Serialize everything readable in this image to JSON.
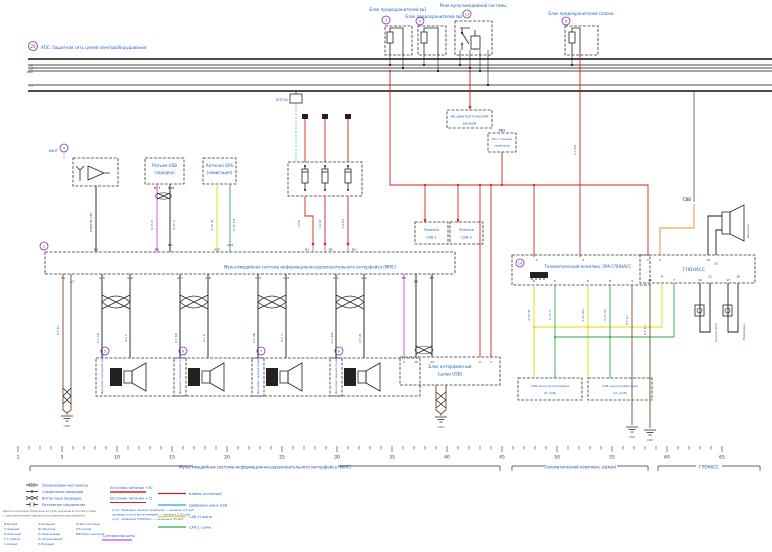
{
  "diagram": {
    "note": {
      "marker": "29",
      "text": "АПС: Защитная сеть цепей электрооборудования"
    },
    "bus": {
      "labels": [
        "30",
        "15",
        "ACC",
        "31"
      ]
    },
    "top": {
      "fuse1": {
        "marker": "3",
        "label": "Блок предохранителей №1"
      },
      "fuse2": {
        "marker": "4",
        "label": "Блок предохранителей №2"
      },
      "relay": {
        "marker": "13",
        "label": "Реле мультимедийной системы"
      },
      "fuse3": {
        "marker": "6",
        "label": "Блок предохранителей салона"
      },
      "svv": "СВВ"
    },
    "left": {
      "ant": {
        "marker": "9",
        "label": "ХАНТ",
        "box": "Усилитель антенны",
        "wire": "КАБЕЛЬ АНТ"
      },
      "usb": {
        "line1": "Разъем USB",
        "line2": "(зарядка)",
        "pin1": "М17",
        "pin2": "М18",
        "wire1": "0,35 Р",
        "wire2": "0,35 Ч"
      },
      "gps": {
        "line1": "Антенна GPS",
        "line2": "(навигация)",
        "wire1": "0,35 Ж",
        "wire2": "0,35 ГЛ"
      },
      "gnd": "GND",
      "gnd_wire": "0,5 Кч"
    },
    "fusebox": {
      "label": "АПТОК",
      "w1": "1,0 К",
      "w2": "1,0 КГ",
      "w3": "1,0 КЗ"
    },
    "head": {
      "marker": "1",
      "label": "Мультимедийная система информационно-развлекательного интерфейса (ММС)",
      "top_pins": [
        "М1",
        "М5",
        "М6",
        "А25",
        "А24",
        "В1",
        "В2",
        "В3"
      ],
      "bottom_pins": [
        "А1",
        "А2",
        "А15",
        "А16",
        "А17",
        "А18",
        "А13",
        "А14",
        "А11",
        "А12",
        "В5",
        "В6",
        "В7"
      ]
    },
    "speakers": [
      {
        "marker": "5",
        "name": "Динамик передний левый",
        "w1": "0,5 СБ",
        "w2": "0,5 С"
      },
      {
        "marker": "6",
        "name": "Динамик передний правый",
        "w1": "0,5 КБ",
        "w2": "0,5 К"
      },
      {
        "marker": "7",
        "name": "Динамик задний левый",
        "w1": "0,5 ЗБ",
        "w2": "0,5 З"
      },
      {
        "marker": "8",
        "name": "Динамик задний правый",
        "w1": "0,5 ЖБ",
        "w2": "0,5 Ж"
      }
    ],
    "mid": {
      "diag": {
        "line1": "На диагностический",
        "line2": "разъем"
      },
      "xv2": {
        "tag": "ХВ2",
        "line1": "Жгут панели",
        "line2": "приборов"
      },
      "usb1": {
        "line1": "Розетка",
        "line2": "USB-1"
      },
      "usb2": {
        "line1": "Розетка",
        "line2": "USB-2"
      },
      "iface": {
        "line1": "Блок интерфейсный",
        "line2": "(шлюз USB)",
        "p1": "4",
        "p2": "10",
        "p3": "14",
        "p4": "2",
        "p5": "3",
        "gnd": "GND"
      }
    },
    "tele": {
      "marker": "14",
      "label": "Телематический комплекс ЭРА-ГЛОНАСС",
      "feed": "2,5 КЗ",
      "tp": [
        "1",
        "2"
      ],
      "bp": [
        "6",
        "5",
        "9",
        "8",
        "4"
      ],
      "w": [
        "0,35 Ж",
        "0,35 З",
        "0,35 ЖЧ",
        "0,35 ЗЧ",
        "0,5 Кч"
      ],
      "gnd": "GND"
    },
    "can1": {
      "line1": "CAN шина мультимедиа",
      "line2": "(K_CAN)"
    },
    "can2": {
      "line1": "CAN шина комбинации",
      "line2": "(CL_CAN)"
    },
    "glonass": {
      "label": "ГЛОНАСС",
      "tp": [
        "1",
        "2",
        "14",
        "15"
      ],
      "bp": [
        "20",
        "8",
        "7",
        "16",
        "11",
        "17",
        "18"
      ],
      "speaker": "Динамик",
      "btn": "Кнопка SOS",
      "mic": "Микрофон",
      "gnd": "GND",
      "w": "0,5 Кч"
    },
    "ruler": {
      "numbers": [
        "1",
        "5",
        "10",
        "15",
        "20",
        "25",
        "30",
        "35",
        "40",
        "45",
        "50",
        "55",
        "60",
        "65"
      ],
      "b1": "Мультимедийная система информационно-развлекательного интерфейса (ММС)",
      "b2": "Телематический комплекс (связи)",
      "b3": "ГЛОНАСС"
    },
    "legend": {
      "symbols": [
        "Экранированный провод",
        "Соединение проводов",
        "Витая пара проводов",
        "Разъемное соединение"
      ],
      "pw1": "Источник питания +30",
      "pw2": "Источник питания +15",
      "c1": "Кабель антенный",
      "c2": "Цифровая шина USB",
      "c3": "CAN_H шина",
      "c4": "CAN_L шина",
      "c5": "Сигнальная цепь",
      "note1a": "Цвета изоляции проводов жгутов указаны в соответствии",
      "note1b": "с обозначениями завода-изготовителя автомобиля",
      "n2a": "жгут проводов панели приборов — сечение 0,5 мм²",
      "n2b": "провода жгута мультимедиа — сечение 0,35 мм²",
      "n2c": "жгут проводов ГЛОНАСС — сечение 0,35 мм²",
      "col1": [
        "Б-Белый",
        "Ч-Черный",
        "К-Красный",
        "Г-Голубой",
        "С-Серый"
      ],
      "col2": [
        "З-Зеленый",
        "Ж-Желтый",
        "О-Оранжевый",
        "Кч-Коричневый",
        "Р-Розовый"
      ],
      "col3": [
        "Ф-Фиолетовый",
        "СН-Синий",
        "БЖ-Бело-желтый"
      ]
    },
    "colors": {
      "blue": "#2060c0",
      "purple": "#8030a0",
      "red": "#d42020",
      "yellow": "#e8d800",
      "green": "#2ea84f",
      "orange": "#f08a20",
      "magenta": "#e040e0",
      "cyan": "#22aadd",
      "brown": "#7a4a20"
    }
  }
}
